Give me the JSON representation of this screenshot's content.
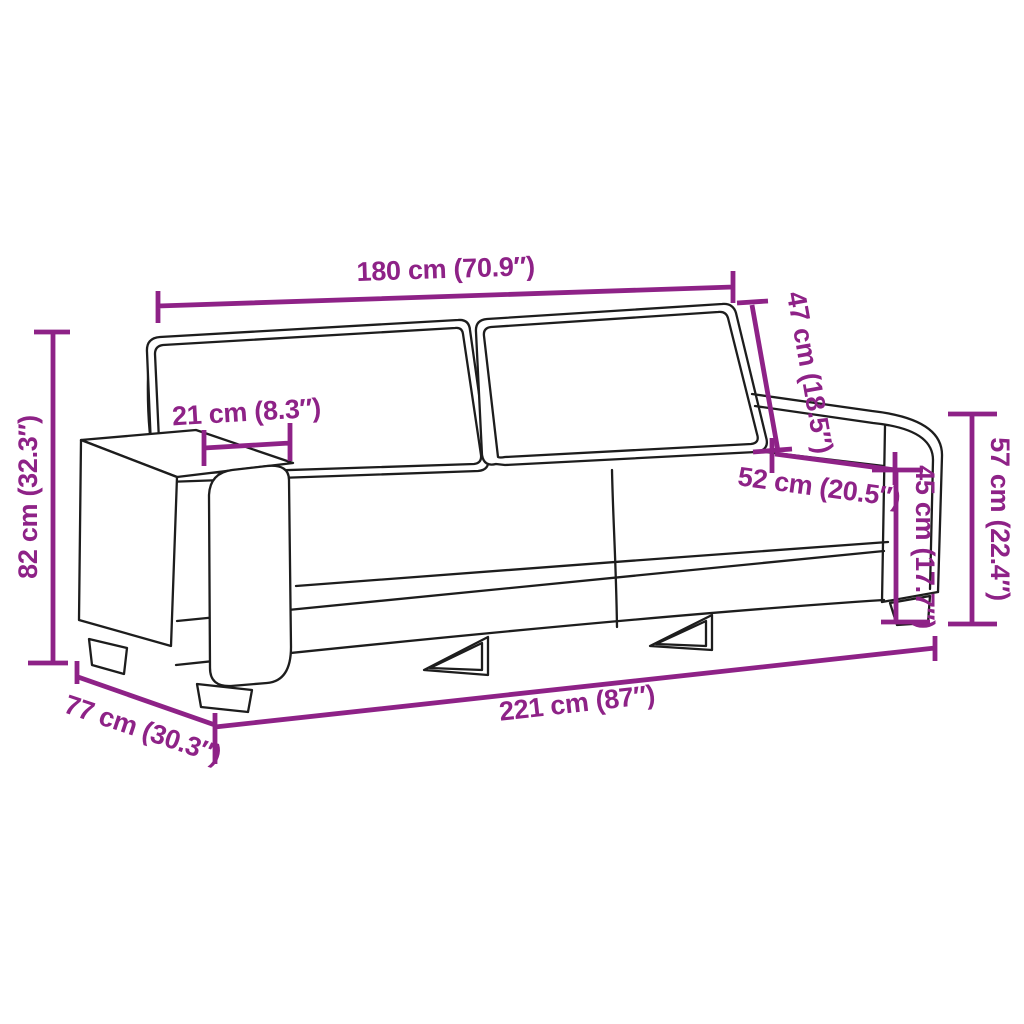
{
  "diagram": {
    "type": "product-dimension-diagram",
    "subject": "3-seater sofa outline drawing with measurement annotations",
    "background_color": "#ffffff",
    "outline_color": "#1d1d1d",
    "dimension_color": "#8E2287",
    "dimensions": [
      {
        "name": "overall-top-width",
        "label": "180 cm (70.9″)"
      },
      {
        "name": "backrest-height",
        "label": "47 cm (18.5″)"
      },
      {
        "name": "seat-depth",
        "label": "52 cm (20.5″)"
      },
      {
        "name": "seat-height",
        "label": "45 cm (17.7″)"
      },
      {
        "name": "armrest-height",
        "label": "57 cm (22.4″)"
      },
      {
        "name": "overall-height",
        "label": "82 cm (32.3″)"
      },
      {
        "name": "armrest-width",
        "label": "21 cm (8.3″)"
      },
      {
        "name": "overall-width",
        "label": "221 cm (87″)"
      },
      {
        "name": "overall-depth",
        "label": "77 cm (30.3″)"
      }
    ]
  }
}
